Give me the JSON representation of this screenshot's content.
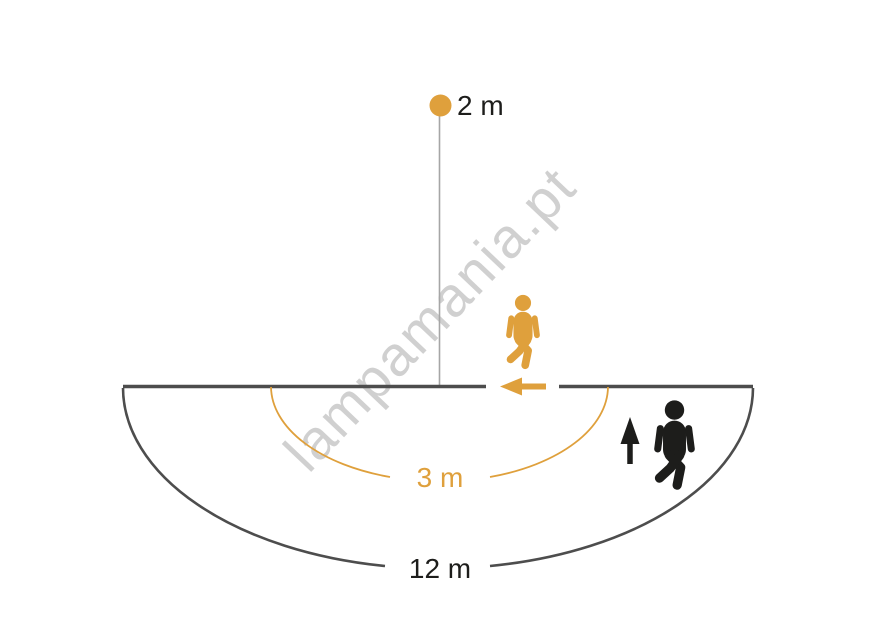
{
  "diagram": {
    "type": "motion-sensor-detection-range",
    "watermark": "lampamania.pt",
    "labels": {
      "mount_height": "2 m",
      "inner_range": "3 m",
      "outer_range": "12 m"
    },
    "colors": {
      "accent_orange": "#DFA03C",
      "figure_black": "#1D1D1B",
      "line_gray": "#4D4D4D",
      "pole_gray": "#A6A6A6",
      "label_dark": "#1D1D1B",
      "watermark_gray": "#C5C5C5"
    },
    "icons": {
      "sensor_dot": "filled-circle",
      "tangential_walker": "person-walking-silhouette",
      "radial_walker": "person-walking-silhouette",
      "tangential_arrow": "arrow-left",
      "radial_arrow": "arrow-up"
    }
  }
}
